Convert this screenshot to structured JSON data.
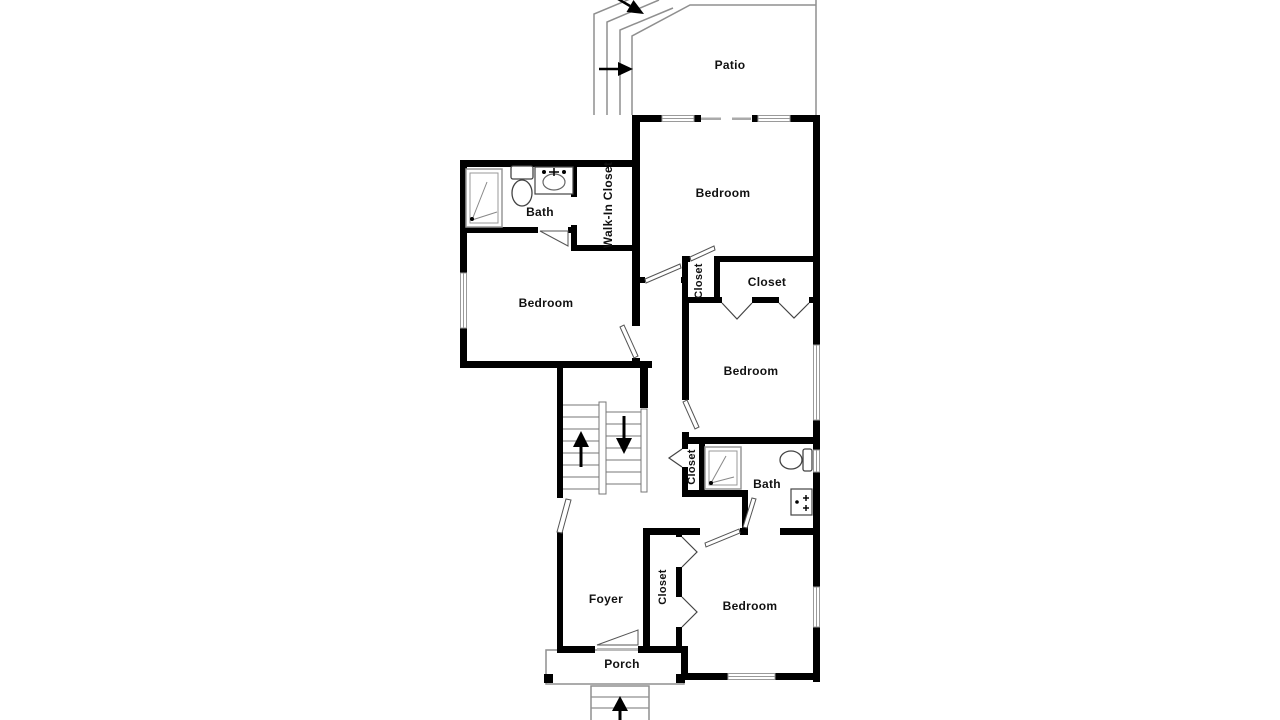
{
  "title": "Floor Plan",
  "colors": {
    "wall": "#000000",
    "thin_line": "#8f8f8f",
    "fixture_line": "#444444",
    "text": "#111111",
    "background": "#ffffff"
  },
  "rooms": [
    {
      "id": "patio",
      "label": "Patio"
    },
    {
      "id": "bedroom-top",
      "label": "Bedroom"
    },
    {
      "id": "bath-upper",
      "label": "Bath"
    },
    {
      "id": "walk-in-closet",
      "label": "Walk-In Closet"
    },
    {
      "id": "bedroom-left",
      "label": "Bedroom"
    },
    {
      "id": "closet-small-top",
      "label": "Closet"
    },
    {
      "id": "closet-top",
      "label": "Closet"
    },
    {
      "id": "bedroom-middle",
      "label": "Bedroom"
    },
    {
      "id": "closet-hall",
      "label": "Closet"
    },
    {
      "id": "bath-lower",
      "label": "Bath"
    },
    {
      "id": "foyer",
      "label": "Foyer"
    },
    {
      "id": "closet-bottom",
      "label": "Closet"
    },
    {
      "id": "bedroom-bottom",
      "label": "Bedroom"
    },
    {
      "id": "porch",
      "label": "Porch"
    }
  ],
  "icons": [
    {
      "id": "patio-arrow-right",
      "meaning": "entry direction arrow"
    },
    {
      "id": "patio-arrow-diagonal",
      "meaning": "exterior steps direction arrow"
    },
    {
      "id": "stairs-up-arrow",
      "meaning": "stairs going up"
    },
    {
      "id": "stairs-down-arrow",
      "meaning": "stairs going down"
    },
    {
      "id": "front-steps-up-arrow",
      "meaning": "front entry steps up"
    }
  ]
}
